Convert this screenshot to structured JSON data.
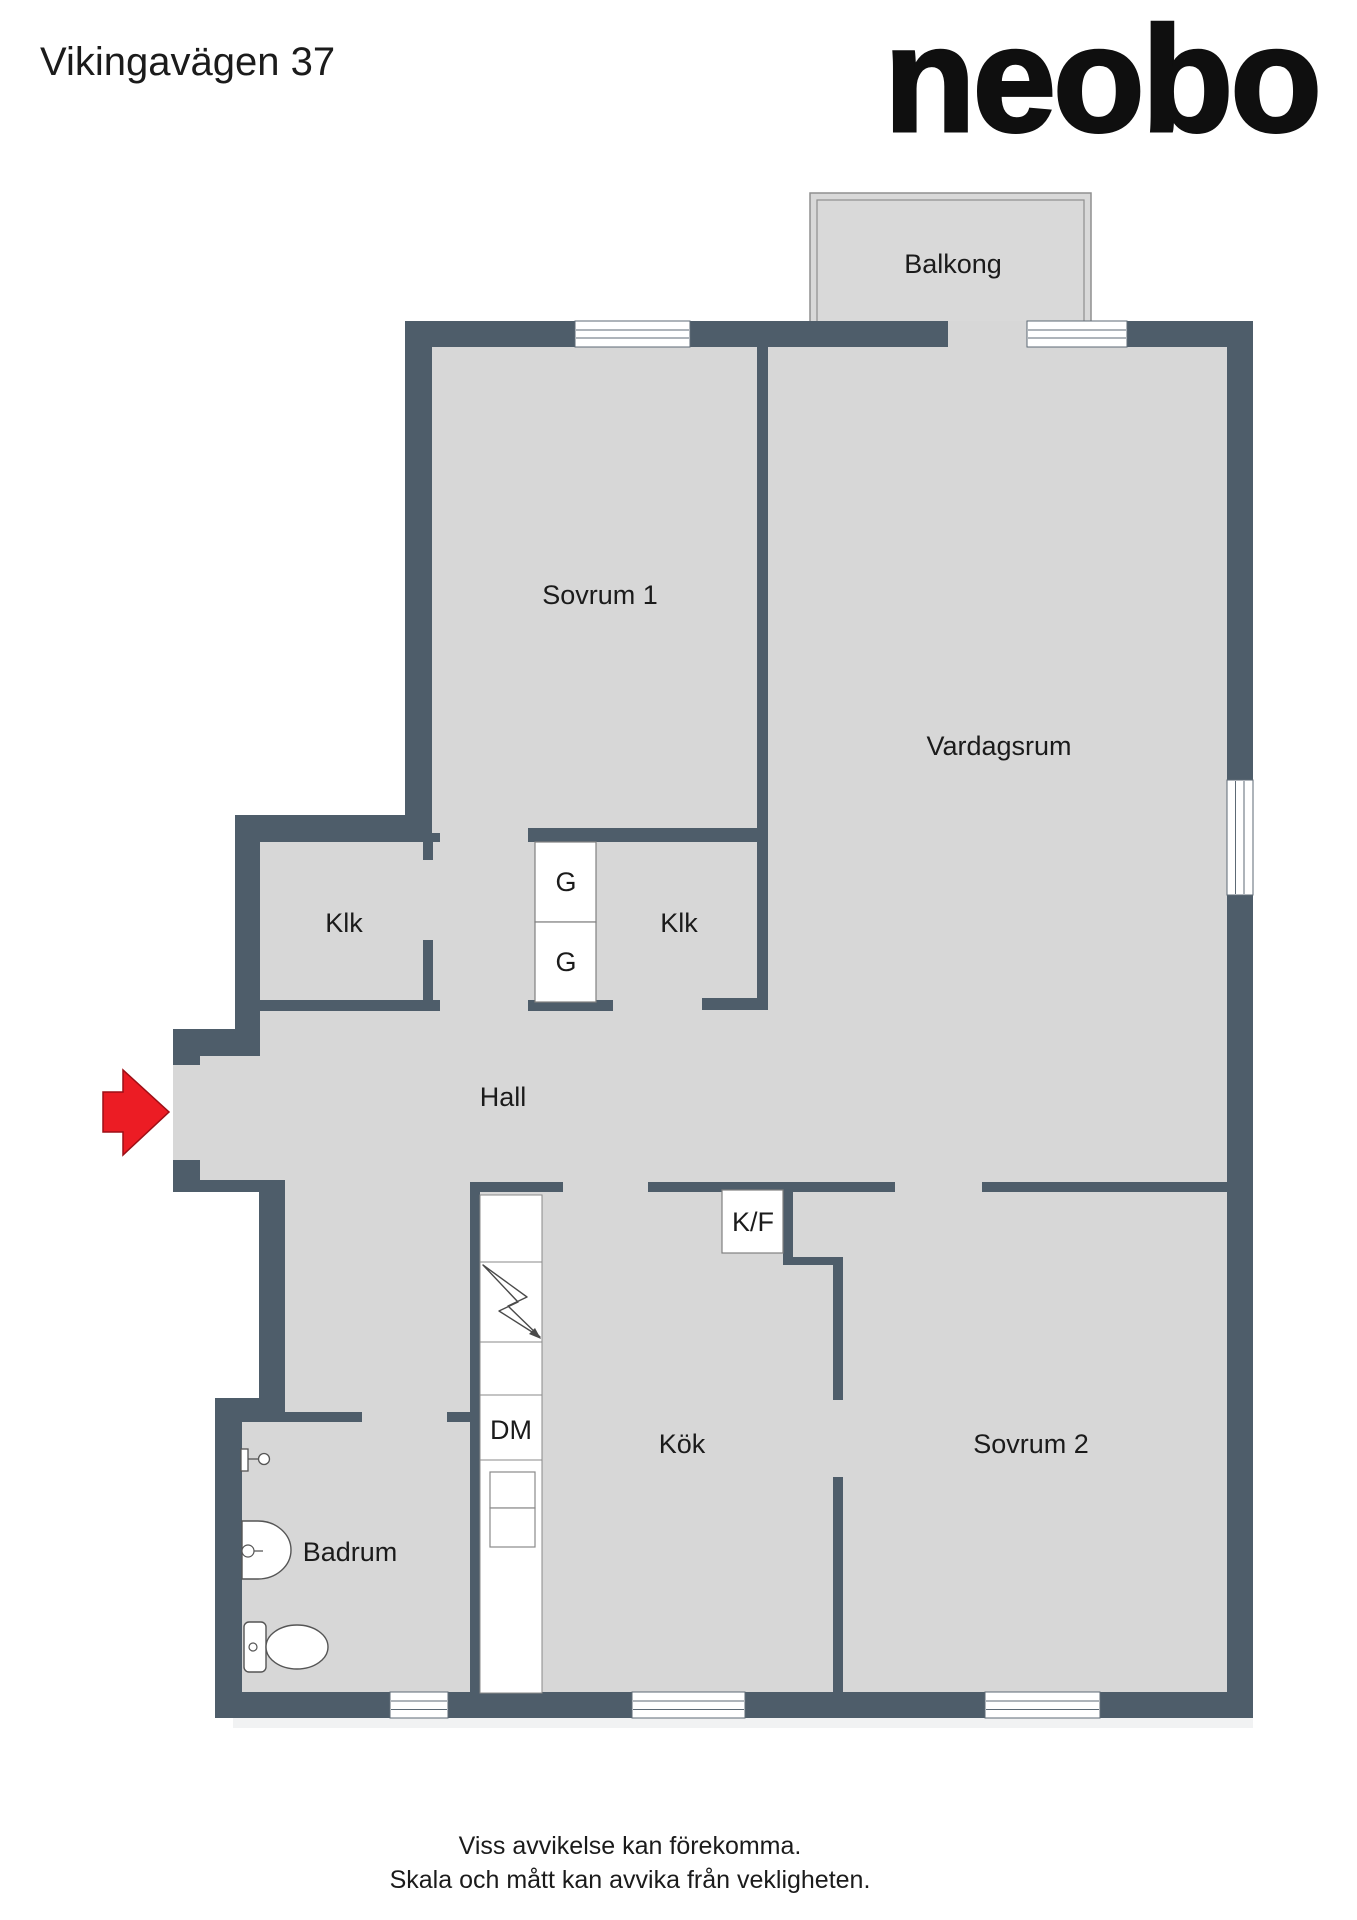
{
  "page": {
    "title": "Vikingavägen 37",
    "brand_logo": "neobo"
  },
  "floorplan": {
    "rooms": {
      "balcony": "Balkong",
      "bedroom1": "Sovrum 1",
      "living_room": "Vardagsrum",
      "closet_left": "Klk",
      "closet_middle": "Klk",
      "wardrobe": "G",
      "hall": "Hall",
      "dishwasher": "DM",
      "fridge_freezer": "K/F",
      "kitchen": "Kök",
      "bedroom2": "Sovrum 2",
      "bathroom": "Badrum"
    },
    "colors": {
      "wall": "#4e5d6a",
      "floor": "#d7d7d7",
      "balcony_floor": "#d9d9d9",
      "arrow": "#ec1c24",
      "text": "#1b1b1b"
    }
  },
  "footer": {
    "line1": "Viss avvikelse kan förekomma.",
    "line2": "Skala och mått kan avvika från vekligheten."
  }
}
